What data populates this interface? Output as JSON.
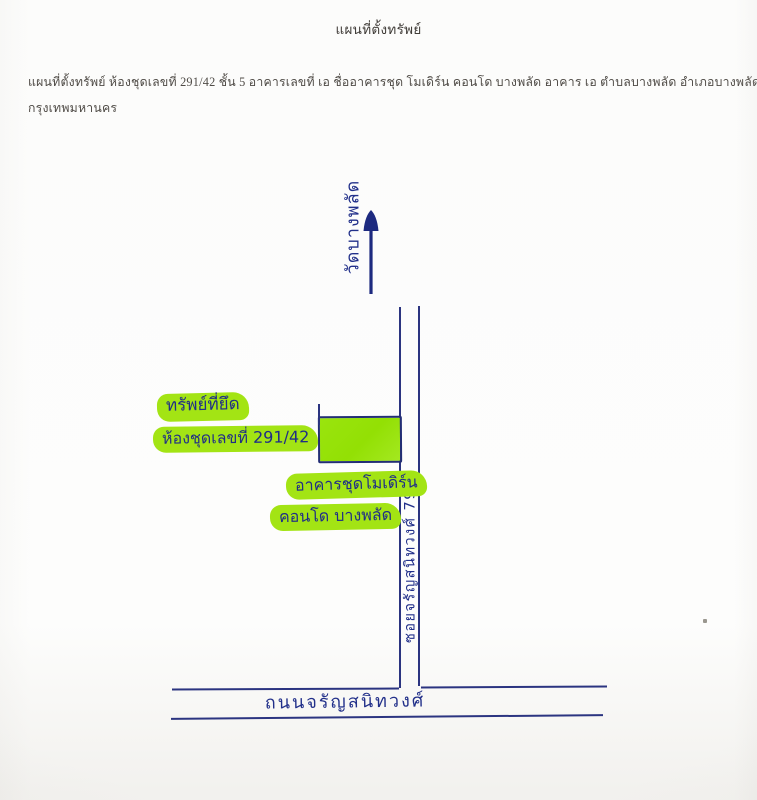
{
  "page": {
    "title": "แผนที่ตั้งทรัพย์",
    "description": {
      "line1": "แผนที่ตั้งทรัพย์ ห้องชุดเลขที่ 291/42 ชั้น 5 อาคารเลขที่ เอ  ชื่ออาคารชุด โมเดิร์น คอนโด บางพลัด อาคาร เอ ตำบลบางพลัด อำเภอบางพลัด",
      "line2": "กรุงเทพมหานคร"
    }
  },
  "map": {
    "direction_label": "วัดบางพลัด",
    "seized_label": "ทรัพย์ที่ยึด",
    "unit_label": "ห้องชุดเลขที่ 291/42",
    "building_label": "อาคารชุดโมเดิร์น",
    "condo_label": "คอนโด บางพลัด",
    "soi_label": "ซอยจรัญสนิทวงศ์ 79",
    "road_label": "ถนนจรัญสนิทวงศ์"
  },
  "colors": {
    "ink_blue": "#22308a",
    "road_line": "#2b3480",
    "highlight_green": "#a3e414",
    "building_fill": "#97e20a",
    "printed_text": "#4f4b46"
  }
}
